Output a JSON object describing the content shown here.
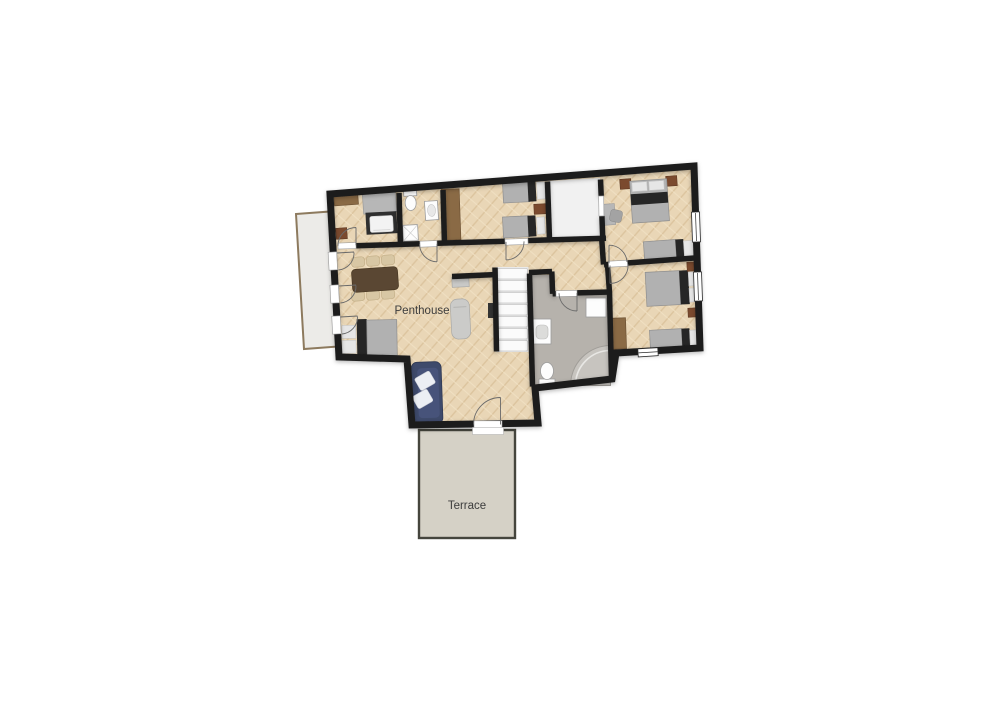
{
  "labels": {
    "penthouse": "Penthouse",
    "terrace": "Terrace"
  },
  "rooms": [
    {
      "label": "Penthouse"
    },
    {
      "label": "Terrace"
    }
  ],
  "palette": {
    "background": "#ffffff",
    "wall": "#1c1c1c",
    "floor": "#e9d6b6",
    "floorLine": "#dcc49e",
    "floorLine2": "#f0e0c2",
    "bath": "#b6b2ac",
    "storage": "#f1f1f1",
    "stairs": "#fbfbfb",
    "terrace": "#d5d1c6",
    "terraceBorder": "#45453d",
    "balcony": "#ecebe8",
    "balconyBorder": "#8d7a5e",
    "sofa": "#3e4a6b",
    "tableWood": "#5a4733",
    "wood": "#8a6a45",
    "woodDark": "#7b4a2e",
    "furnGray": "#b1b1b1",
    "furnDark": "#262626",
    "text": "#3c3c3c"
  }
}
